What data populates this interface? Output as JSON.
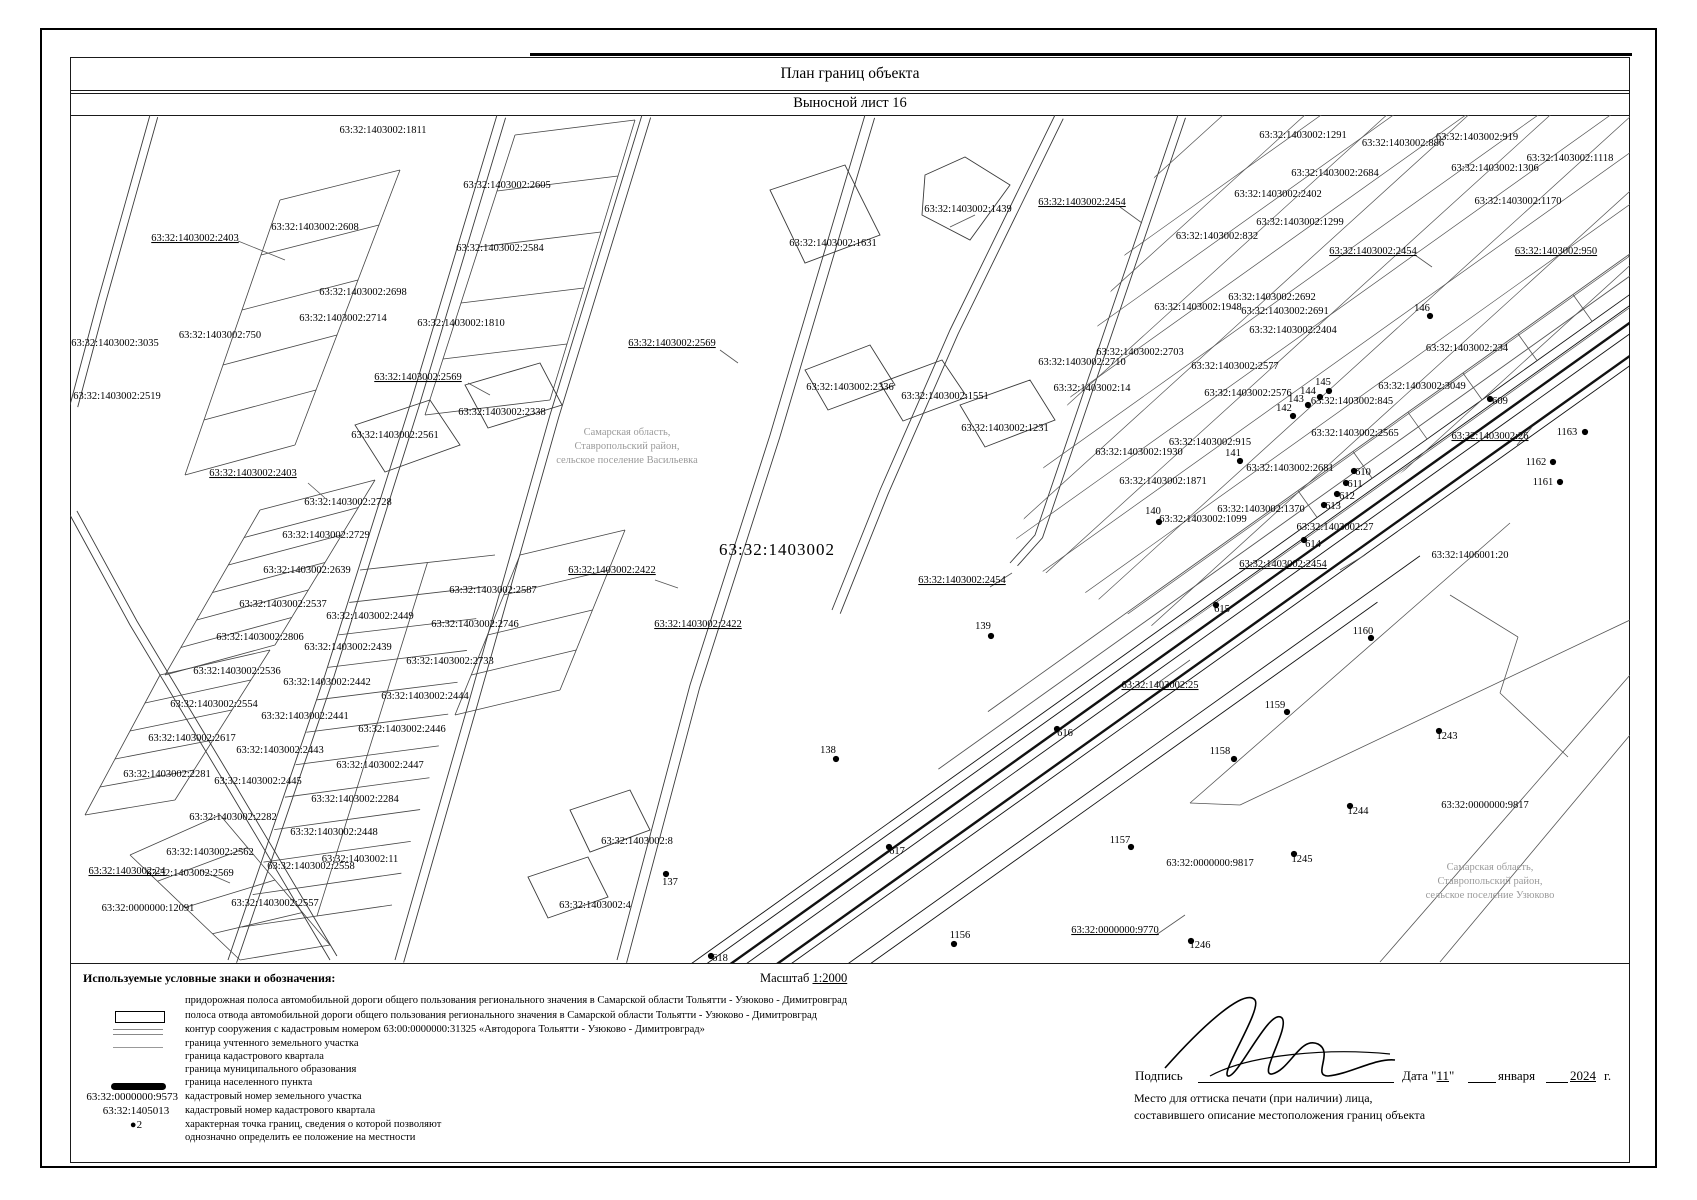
{
  "title": "План границ объекта",
  "subtitle": "Выносной лист 16",
  "legend": {
    "header": "Используемые условные знаки и обозначения:",
    "scale_prefix": "Масштаб",
    "scale_value": "1:2000",
    "rows": [
      "придорожная полоса автомобильной дороги общего пользования регионального значения в Самарской области Тольятти - Узюково - Димитровград",
      "полоса отвода автомобильной дороги общего пользования регионального значения в Самарской области Тольятти - Узюково - Димитровград",
      "контур сооружения с кадастровым номером 63:00:0000000:31325 «Автодорога Тольятти - Узюково - Димитровград»",
      "граница учтенного земельного участка",
      "граница кадастрового квартала",
      "граница муниципального образования",
      "граница населенного пункта",
      "кадастровый номер земельного участка",
      "кадастровый номер кадастрового квартала",
      "характерная точка границ, сведения о которой позволяют",
      "однозначно определить ее положение на местности"
    ],
    "parcel_number_sample": "63:32:0000000:9573",
    "quarter_number_sample": "63:32:1405013",
    "point_sample": "●2"
  },
  "signature": {
    "sign_label": "Подпись",
    "date_label": "Дата",
    "day": "11",
    "month": "января",
    "year": "2024",
    "year_suffix": "г.",
    "stamp_note_line1": "Место для оттиска печати (при наличии) лица,",
    "stamp_note_line2": "составившего описание местоположения границ объекта"
  },
  "map": {
    "quarter_label": {
      "t": "63:32:1403002",
      "x": 707,
      "y": 440
    },
    "region_notes": [
      {
        "x": 557,
        "y": 320,
        "lines": [
          "Самарская область,",
          "Ставропольский район,",
          "сельское поселение Васильевка"
        ]
      },
      {
        "x": 1420,
        "y": 755,
        "lines": [
          "Самарская область,",
          "Ставропольский район,",
          "сельское поселение Узюково"
        ]
      }
    ],
    "labels": [
      {
        "t": "63:32:1403002:1811",
        "x": 313,
        "y": 18
      },
      {
        "t": "63:32:1403002:2403",
        "x": 125,
        "y": 126,
        "u": 1
      },
      {
        "t": "63:32:1403002:2608",
        "x": 245,
        "y": 115
      },
      {
        "t": "63:32:1403002:2605",
        "x": 437,
        "y": 73
      },
      {
        "t": "63:32:1403002:2584",
        "x": 430,
        "y": 136
      },
      {
        "t": "63:32:1403002:2698",
        "x": 293,
        "y": 180
      },
      {
        "t": "63:32:1403002:2714",
        "x": 273,
        "y": 206
      },
      {
        "t": "63:32:1403002:1810",
        "x": 391,
        "y": 211
      },
      {
        "t": "63:32:1403002:750",
        "x": 150,
        "y": 223
      },
      {
        "t": "63:32:1403002:3035",
        "x": 45,
        "y": 231
      },
      {
        "t": "63:32:1403002:2519",
        "x": 47,
        "y": 284
      },
      {
        "t": "63:32:1403002:2569",
        "x": 348,
        "y": 265,
        "u": 1
      },
      {
        "t": "63:32:1403002:2569",
        "x": 602,
        "y": 231,
        "u": 1
      },
      {
        "t": "63:32:1403002:2336",
        "x": 780,
        "y": 275
      },
      {
        "t": "63:32:1403002:1551",
        "x": 875,
        "y": 284
      },
      {
        "t": "63:32:1403002:1631",
        "x": 763,
        "y": 131
      },
      {
        "t": "63:32:1403002:1439",
        "x": 898,
        "y": 97
      },
      {
        "t": "63:32:1403002:2561",
        "x": 325,
        "y": 323
      },
      {
        "t": "63:32:1403002:2338",
        "x": 432,
        "y": 300
      },
      {
        "t": "63:32:1403002:2403",
        "x": 183,
        "y": 361,
        "u": 1
      },
      {
        "t": "63:32:1403002:2728",
        "x": 278,
        "y": 390
      },
      {
        "t": "63:32:1403002:2729",
        "x": 256,
        "y": 423
      },
      {
        "t": "63:32:1403002:2639",
        "x": 237,
        "y": 458
      },
      {
        "t": "63:32:1403002:2537",
        "x": 213,
        "y": 492
      },
      {
        "t": "63:32:1403002:2449",
        "x": 300,
        "y": 504
      },
      {
        "t": "63:32:1403002:2806",
        "x": 190,
        "y": 525
      },
      {
        "t": "63:32:1403002:2439",
        "x": 278,
        "y": 535
      },
      {
        "t": "63:32:1403002:2587",
        "x": 423,
        "y": 478
      },
      {
        "t": "63:32:1403002:2746",
        "x": 405,
        "y": 512
      },
      {
        "t": "63:32:1403002:2733",
        "x": 380,
        "y": 549
      },
      {
        "t": "63:32:1403002:2536",
        "x": 167,
        "y": 559
      },
      {
        "t": "63:32:1403002:2442",
        "x": 257,
        "y": 570
      },
      {
        "t": "63:32:1403002:2444",
        "x": 355,
        "y": 584
      },
      {
        "t": "63:32:1403002:2554",
        "x": 144,
        "y": 592
      },
      {
        "t": "63:32:1403002:2441",
        "x": 235,
        "y": 604
      },
      {
        "t": "63:32:1403002:2446",
        "x": 332,
        "y": 617
      },
      {
        "t": "63:32:1403002:2617",
        "x": 122,
        "y": 626
      },
      {
        "t": "63:32:1403002:2443",
        "x": 210,
        "y": 638
      },
      {
        "t": "63:32:1403002:2447",
        "x": 310,
        "y": 653
      },
      {
        "t": "63:32:1403002:2281",
        "x": 97,
        "y": 662
      },
      {
        "t": "63:32:1403002:2445",
        "x": 188,
        "y": 669
      },
      {
        "t": "63:32:1403002:2284",
        "x": 285,
        "y": 687
      },
      {
        "t": "63:32:1403002:2282",
        "x": 163,
        "y": 705
      },
      {
        "t": "63:32:1403002:2448",
        "x": 264,
        "y": 720
      },
      {
        "t": "63:32:1403002:2562",
        "x": 140,
        "y": 740
      },
      {
        "t": "63:32:1403002:2558",
        "x": 241,
        "y": 754
      },
      {
        "t": "63:32:1403002:24",
        "x": 57,
        "y": 759,
        "u": 1
      },
      {
        "t": "63:32:1403002:2569",
        "x": 120,
        "y": 761
      },
      {
        "t": "63:32:0000000:12091",
        "x": 78,
        "y": 796
      },
      {
        "t": "63:32:1403002:2557",
        "x": 205,
        "y": 791
      },
      {
        "t": "63:32:1403002:11",
        "x": 290,
        "y": 747
      },
      {
        "t": "63:32:1403002:8",
        "x": 567,
        "y": 729
      },
      {
        "t": "63:32:1403002:4",
        "x": 525,
        "y": 793
      },
      {
        "t": "137",
        "x": 600,
        "y": 770
      },
      {
        "t": "138",
        "x": 758,
        "y": 638
      },
      {
        "t": "139",
        "x": 913,
        "y": 514
      },
      {
        "t": "63:32:1403002:2422",
        "x": 542,
        "y": 458,
        "u": 1
      },
      {
        "t": "63:32:1403002:2422",
        "x": 628,
        "y": 512,
        "u": 1
      },
      {
        "t": "63:32:1403002:2454",
        "x": 892,
        "y": 468,
        "u": 1
      },
      {
        "t": "63:32:1403002:2454",
        "x": 1012,
        "y": 90,
        "u": 1
      },
      {
        "t": "63:32:1403002:2454",
        "x": 1303,
        "y": 139,
        "u": 1
      },
      {
        "t": "63:32:1403002:1291",
        "x": 1233,
        "y": 23
      },
      {
        "t": "63:32:1403002:886",
        "x": 1333,
        "y": 31
      },
      {
        "t": "63:32:1403002:919",
        "x": 1407,
        "y": 25
      },
      {
        "t": "63:32:1403002:1118",
        "x": 1500,
        "y": 46
      },
      {
        "t": "63:32:1403002:2684",
        "x": 1265,
        "y": 61
      },
      {
        "t": "63:32:1403002:1306",
        "x": 1425,
        "y": 56
      },
      {
        "t": "63:32:1403002:2402",
        "x": 1208,
        "y": 82
      },
      {
        "t": "63:32:1403002:1170",
        "x": 1448,
        "y": 89
      },
      {
        "t": "63:32:1403002:1299",
        "x": 1230,
        "y": 110
      },
      {
        "t": "63:32:1403002:832",
        "x": 1147,
        "y": 124
      },
      {
        "t": "63:32:1403002:950",
        "x": 1486,
        "y": 139,
        "u": 1
      },
      {
        "t": "63:32:1403002:2692",
        "x": 1202,
        "y": 185
      },
      {
        "t": "63:32:1403002:1948",
        "x": 1128,
        "y": 195
      },
      {
        "t": "63:32:1403002:2691",
        "x": 1215,
        "y": 199
      },
      {
        "t": "63:32:1403002:2404",
        "x": 1223,
        "y": 218
      },
      {
        "t": "146",
        "x": 1352,
        "y": 196
      },
      {
        "t": "63:32:1403002:2703",
        "x": 1070,
        "y": 240
      },
      {
        "t": "63:32:1403002:2710",
        "x": 1012,
        "y": 250
      },
      {
        "t": "63:32:1403002:14",
        "x": 1022,
        "y": 276
      },
      {
        "t": "63:32:1403002:2577",
        "x": 1165,
        "y": 254
      },
      {
        "t": "63:32:1403002:2576",
        "x": 1178,
        "y": 281
      },
      {
        "t": "63:32:1403002:234",
        "x": 1397,
        "y": 236
      },
      {
        "t": "63:32:1403002:3049",
        "x": 1352,
        "y": 274
      },
      {
        "t": "63:32:1403002:845",
        "x": 1282,
        "y": 289
      },
      {
        "t": "145",
        "x": 1253,
        "y": 270
      },
      {
        "t": "144",
        "x": 1238,
        "y": 279
      },
      {
        "t": "143",
        "x": 1226,
        "y": 287
      },
      {
        "t": "142",
        "x": 1214,
        "y": 296
      },
      {
        "t": "609",
        "x": 1430,
        "y": 289
      },
      {
        "t": "63:32:1403002:2565",
        "x": 1285,
        "y": 321
      },
      {
        "t": "63:32:1403002:26",
        "x": 1420,
        "y": 324,
        "u": 1
      },
      {
        "t": "1163",
        "x": 1497,
        "y": 320
      },
      {
        "t": "1162",
        "x": 1466,
        "y": 350
      },
      {
        "t": "1161",
        "x": 1473,
        "y": 370
      },
      {
        "t": "63:32:1403002:1231",
        "x": 935,
        "y": 316
      },
      {
        "t": "63:32:1403002:1930",
        "x": 1069,
        "y": 340
      },
      {
        "t": "63:32:1403002:915",
        "x": 1140,
        "y": 330
      },
      {
        "t": "141",
        "x": 1163,
        "y": 341
      },
      {
        "t": "63:32:1403002:1871",
        "x": 1093,
        "y": 369
      },
      {
        "t": "63:32:1403002:2681",
        "x": 1220,
        "y": 356
      },
      {
        "t": "610",
        "x": 1293,
        "y": 360
      },
      {
        "t": "611",
        "x": 1285,
        "y": 372
      },
      {
        "t": "612",
        "x": 1277,
        "y": 384
      },
      {
        "t": "613",
        "x": 1263,
        "y": 394
      },
      {
        "t": "140",
        "x": 1083,
        "y": 399
      },
      {
        "t": "63:32:1403002:1370",
        "x": 1191,
        "y": 397
      },
      {
        "t": "63:32:1403002:1099",
        "x": 1133,
        "y": 407
      },
      {
        "t": "614",
        "x": 1243,
        "y": 432
      },
      {
        "t": "63:32:1403002:2454",
        "x": 1213,
        "y": 452,
        "u": 1
      },
      {
        "t": "615",
        "x": 1152,
        "y": 497
      },
      {
        "t": "63:32:1403002:25",
        "x": 1090,
        "y": 573,
        "u": 1
      },
      {
        "t": "616",
        "x": 995,
        "y": 621
      },
      {
        "t": "617",
        "x": 827,
        "y": 739
      },
      {
        "t": "618",
        "x": 650,
        "y": 846
      },
      {
        "t": "63:32:1406001:20",
        "x": 1400,
        "y": 443
      },
      {
        "t": "63:32:1403002:27",
        "x": 1265,
        "y": 415
      },
      {
        "t": "1160",
        "x": 1293,
        "y": 519
      },
      {
        "t": "1159",
        "x": 1205,
        "y": 593
      },
      {
        "t": "1158",
        "x": 1150,
        "y": 639
      },
      {
        "t": "1157",
        "x": 1050,
        "y": 728
      },
      {
        "t": "1156",
        "x": 890,
        "y": 823
      },
      {
        "t": "1243",
        "x": 1377,
        "y": 624
      },
      {
        "t": "1244",
        "x": 1288,
        "y": 699
      },
      {
        "t": "1245",
        "x": 1232,
        "y": 747
      },
      {
        "t": "1246",
        "x": 1130,
        "y": 833
      },
      {
        "t": "63:32:0000000:9817",
        "x": 1415,
        "y": 693
      },
      {
        "t": "63:32:0000000:9817",
        "x": 1140,
        "y": 751
      },
      {
        "t": "63:32:0000000:9770",
        "x": 1045,
        "y": 818,
        "u": 1
      }
    ],
    "points": [
      {
        "x": 1360,
        "y": 201
      },
      {
        "x": 1170,
        "y": 346
      },
      {
        "x": 1089,
        "y": 407
      },
      {
        "x": 1259,
        "y": 276
      },
      {
        "x": 1250,
        "y": 282
      },
      {
        "x": 1238,
        "y": 290
      },
      {
        "x": 1223,
        "y": 301
      },
      {
        "x": 1420,
        "y": 284
      },
      {
        "x": 1284,
        "y": 356
      },
      {
        "x": 1276,
        "y": 368
      },
      {
        "x": 1267,
        "y": 379
      },
      {
        "x": 1254,
        "y": 390
      },
      {
        "x": 1234,
        "y": 425
      },
      {
        "x": 1146,
        "y": 490
      },
      {
        "x": 987,
        "y": 614
      },
      {
        "x": 819,
        "y": 732
      },
      {
        "x": 641,
        "y": 841
      },
      {
        "x": 1515,
        "y": 317
      },
      {
        "x": 1483,
        "y": 347
      },
      {
        "x": 1490,
        "y": 367
      },
      {
        "x": 1301,
        "y": 523
      },
      {
        "x": 1217,
        "y": 597
      },
      {
        "x": 1164,
        "y": 644
      },
      {
        "x": 1061,
        "y": 732
      },
      {
        "x": 884,
        "y": 829
      },
      {
        "x": 1369,
        "y": 616
      },
      {
        "x": 1280,
        "y": 691
      },
      {
        "x": 1224,
        "y": 739
      },
      {
        "x": 1121,
        "y": 826
      },
      {
        "x": 596,
        "y": 759
      },
      {
        "x": 766,
        "y": 644
      },
      {
        "x": 921,
        "y": 521
      }
    ]
  }
}
